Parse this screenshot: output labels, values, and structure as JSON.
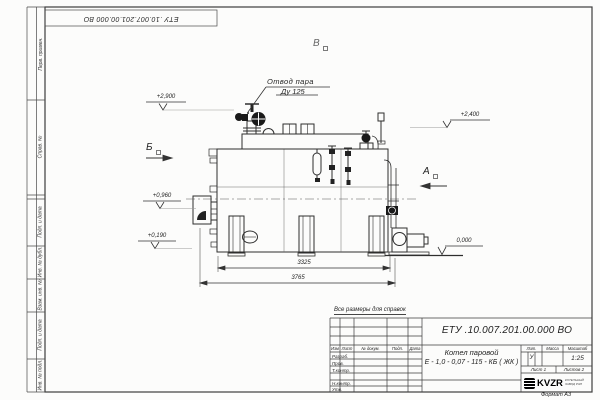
{
  "sheet": {
    "stamp_top": "ЕТУ .10.007.201.00.000  ВО",
    "note": "Все размеры для справок",
    "format_label": "Формат А3",
    "margin_labels": {
      "perv_primen": "Перв. примен.",
      "sprav_no": "Справ. №",
      "podp_data_upper": "Подп. и дата",
      "inv_dubl": "Инв. № дубл.",
      "vzam_inv": "Взам. инв. №",
      "podp_data_lower": "Подп. и дата",
      "inv_podl": "Инв. № подл."
    }
  },
  "drawing": {
    "callout_line1": "Отвод пара",
    "callout_line2": "Ду 125",
    "view_top": "В",
    "view_left": "Б",
    "view_right": "А",
    "elev_valve": "+2,900",
    "elev_right": "+2,400",
    "elev_burner": "+0,960",
    "elev_low": "+0,190",
    "elev_zero": "0,000",
    "dim_inner": "3325",
    "dim_overall": "3765"
  },
  "title_block": {
    "doc_number": "ЕТУ .10.007.201.00.000  ВО",
    "product_line1": "Котел паровой",
    "product_line2": "Е - 1,0 - 0,07 - 115 - КБ ( ЖК )",
    "col_izm": "Изм",
    "col_list": "Лист",
    "col_doc": "№ докум.",
    "col_podp": "Подп.",
    "col_data": "Дата",
    "row_razrab": "Разраб.",
    "row_prov": "Пров.",
    "row_tkontr": "Т.контр.",
    "row_nkontr": "Н.контр.",
    "row_utv": "Утв.",
    "lit_header": "Лит.",
    "mass_header": "Масса",
    "scale_header": "Масштаб",
    "lit_value": "У",
    "scale_value": "1:25",
    "sheet_label": "Лист",
    "sheet_value": "1",
    "sheets_label": "Листов",
    "sheets_value": "2",
    "logo_text": "KVZR",
    "logo_sub1": "КОТЕЛЬНЫЙ",
    "logo_sub2": "ЗАВОД РЭП"
  }
}
